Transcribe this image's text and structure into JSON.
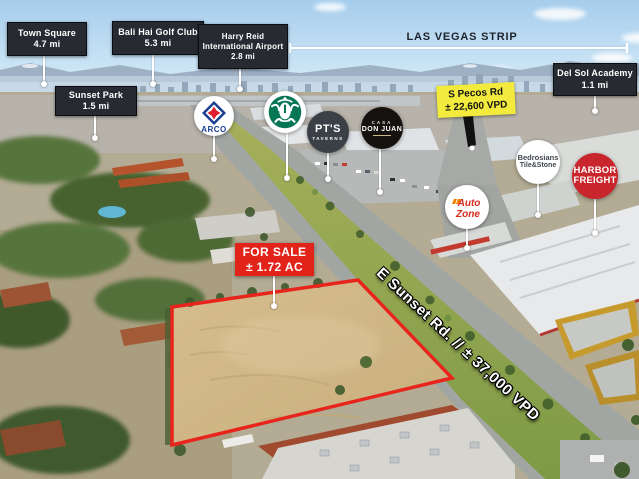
{
  "strip": {
    "label": "LAS VEGAS STRIP"
  },
  "callouts": [
    {
      "name": "Town Square",
      "distance": "4.7 mi"
    },
    {
      "name": "Bali Hai Golf Club",
      "distance": "5.3 mi"
    },
    {
      "name": "Harry Reid International Airport",
      "distance": "2.8 mi"
    },
    {
      "name": "Sunset Park",
      "distance": "1.5 mi"
    },
    {
      "name": "Del Sol Academy",
      "distance": "1.1 mi"
    }
  ],
  "traffic": {
    "pecos": {
      "road": "S Pecos Rd",
      "volume": "± 22,600 VPD"
    },
    "sunset": {
      "label": "E Sunset Rd. // ± 37,000 VPD"
    }
  },
  "sale": {
    "line1": "FOR SALE",
    "line2": "± 1.72 AC"
  },
  "logos": {
    "arco": {
      "label": "ARCO",
      "icon": "arco-spark-icon",
      "blue": "#1c3f94",
      "red": "#e01d2c"
    },
    "starbucks": {
      "icon": "starbucks-siren-icon",
      "green": "#067655"
    },
    "pts": {
      "line1": "PT'S",
      "line2": "TAVERNS"
    },
    "donjuan": {
      "line1": "CASA",
      "line2": "DON JUAN"
    },
    "autozone": {
      "line1": "Auto",
      "line2": "Zone",
      "red": "#d52b1e",
      "orange": "#f37f00"
    },
    "bedrosians": {
      "line1": "Bedrosians",
      "line2": "Tile&Stone"
    },
    "harbor": {
      "line1": "HARBOR",
      "line2": "FREIGHT"
    }
  },
  "colors": {
    "sale_red": "#e2231a",
    "parcel_outline_red": "#e8251c",
    "callout_dark": "#272b31",
    "traffic_yellow": "#f2ea3d",
    "harbor_red": "#c9252c",
    "annotation_white": "#ffffff"
  }
}
